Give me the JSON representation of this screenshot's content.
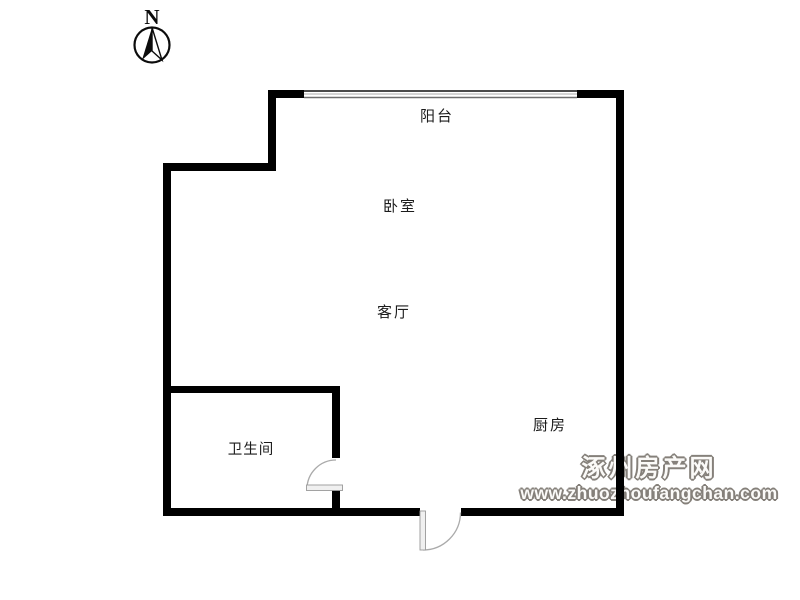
{
  "compass": {
    "label": "N"
  },
  "rooms": [
    {
      "id": "balcony",
      "label": "阳台"
    },
    {
      "id": "bedroom",
      "label": "卧室"
    },
    {
      "id": "living-room",
      "label": "客厅"
    },
    {
      "id": "bathroom",
      "label": "卫生间"
    },
    {
      "id": "kitchen",
      "label": "厨房"
    }
  ],
  "watermark": {
    "site_name": "涿州房产网",
    "site_url": "www.zhuozhoufangchan.com"
  },
  "colors": {
    "wall": "#000000",
    "window_frame": "#4a4a4a",
    "window_line": "#999999",
    "door_line": "#aaaaaa",
    "door_leaf_fill": "#f0f0f0",
    "label_text": "#1c1c1c",
    "watermark_outline": "#85807a",
    "background": "#ffffff"
  }
}
